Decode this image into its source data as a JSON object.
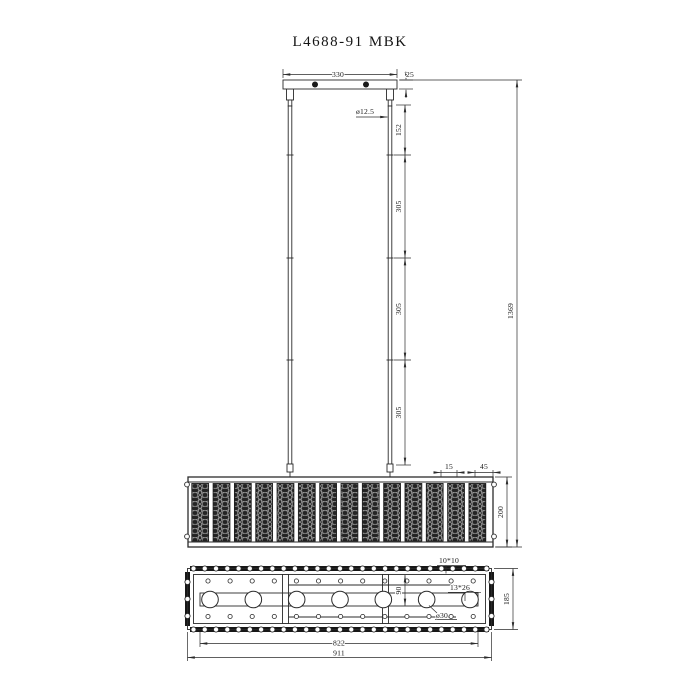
{
  "title": "L4688-91 MBK",
  "front_view": {
    "canopy_width": "330",
    "canopy_thickness": "25",
    "rod_diameter": "ø12.5",
    "rod_segment_1": "152",
    "rod_segment_2": "305",
    "rod_segment_3": "305",
    "rod_segment_4": "305",
    "overall_height": "1369",
    "panel_gap": "15",
    "panel_width": "45",
    "body_height": "200"
  },
  "plan_view": {
    "bead_size": "10*10",
    "arm_profile": "13*26",
    "socket_diameter": "ø30",
    "socket_offset": "90",
    "arm_length": "822",
    "overall_length": "911",
    "overall_width": "185"
  },
  "figure": {
    "crystal_panel_count": 14,
    "socket_count": 7,
    "canopy_hole_count": 2,
    "beads_per_row": 27,
    "beads_per_side": 3,
    "holes_per_row": 13
  },
  "colors": {
    "line": "#2b2b2b",
    "panel_fill": "#242424",
    "panel_mesh": "#b5b5b5",
    "background": "#ffffff"
  }
}
